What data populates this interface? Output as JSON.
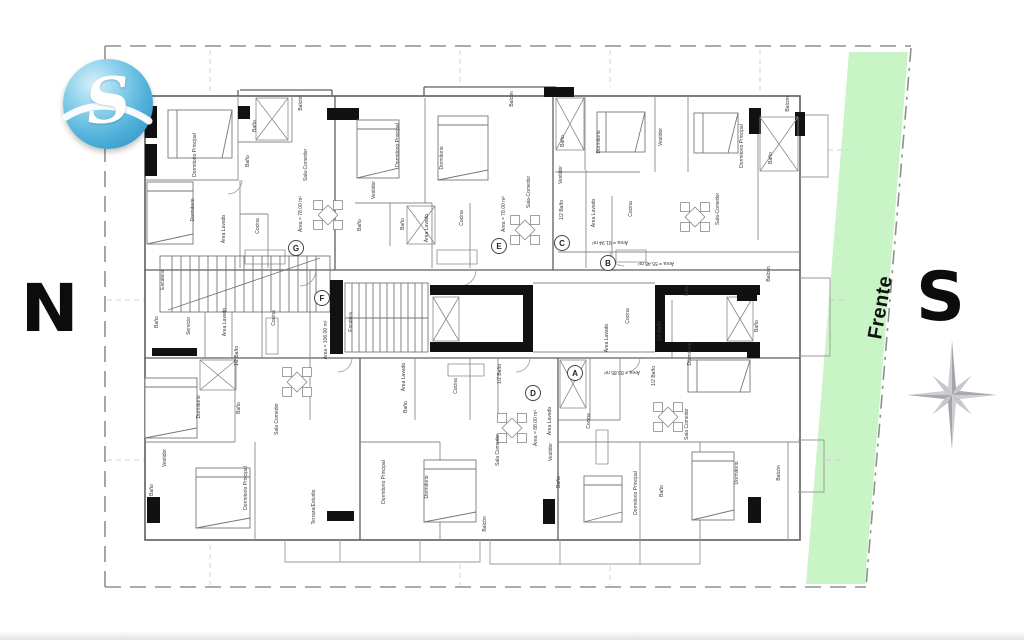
{
  "logo": {
    "letter": "S",
    "color_main": "#4fb0d9",
    "color_light": "#d6f0fa",
    "color_dark": "#2c8cba"
  },
  "compass": {
    "north_label": "N",
    "south_label": "S",
    "star_color": "#b0b0b6"
  },
  "site": {
    "frente_label": "Frente",
    "strip_color": "#c9f4c6",
    "boundary_color": "#8f8f8f"
  },
  "plan": {
    "wall_color": "#666666",
    "label_color": "#3a3a3a",
    "units": [
      {
        "letter": "A",
        "area": "Área = 83.85 m²",
        "cx": 575,
        "cy": 373,
        "ax": 622,
        "ay": 371,
        "ar": 180
      },
      {
        "letter": "B",
        "area": "Área = 55.48 m²",
        "cx": 608,
        "cy": 263,
        "ax": 656,
        "ay": 262,
        "ar": 180
      },
      {
        "letter": "C",
        "area": "Área = 91.94 m²",
        "cx": 562,
        "cy": 243,
        "ax": 610,
        "ay": 241,
        "ar": 180
      },
      {
        "letter": "D",
        "area": "Área = 88.00 m²",
        "cx": 533,
        "cy": 393,
        "ax": 537,
        "ay": 428,
        "ar": -90
      },
      {
        "letter": "E",
        "area": "Área = 78.00 m²",
        "cx": 499,
        "cy": 246,
        "ax": 505,
        "ay": 214,
        "ar": -90
      },
      {
        "letter": "F",
        "area": "Área = 106.00 m²",
        "cx": 322,
        "cy": 298,
        "ax": 327,
        "ay": 340,
        "ar": -90
      },
      {
        "letter": "G",
        "area": "Área = 78.00 m²",
        "cx": 296,
        "cy": 248,
        "ax": 302,
        "ay": 214,
        "ar": -90
      }
    ],
    "rooms": [
      {
        "t": "Balcón",
        "x": 302,
        "y": 103,
        "r": -90
      },
      {
        "t": "Balcón",
        "x": 513,
        "y": 99,
        "r": -90
      },
      {
        "t": "Balcón",
        "x": 789,
        "y": 104,
        "r": -90
      },
      {
        "t": "Dormitorio Principal",
        "x": 196,
        "y": 155,
        "r": -90
      },
      {
        "t": "Dormitorio",
        "x": 194,
        "y": 210,
        "r": -90
      },
      {
        "t": "Baño",
        "x": 256,
        "y": 126,
        "r": -90
      },
      {
        "t": "Baño",
        "x": 249,
        "y": 161,
        "r": -90
      },
      {
        "t": "Área Lavado",
        "x": 225,
        "y": 229,
        "r": -90
      },
      {
        "t": "Cocina",
        "x": 259,
        "y": 226,
        "r": -90
      },
      {
        "t": "Sala-Comedor",
        "x": 307,
        "y": 165,
        "r": -90
      },
      {
        "t": "Dormitorio Principal",
        "x": 399,
        "y": 145,
        "r": -90
      },
      {
        "t": "Dormitorio",
        "x": 443,
        "y": 158,
        "r": -90
      },
      {
        "t": "Vestidor",
        "x": 375,
        "y": 190,
        "r": -90
      },
      {
        "t": "Baño",
        "x": 361,
        "y": 225,
        "r": -90
      },
      {
        "t": "Baño",
        "x": 404,
        "y": 224,
        "r": -90
      },
      {
        "t": "Área Lavado",
        "x": 428,
        "y": 228,
        "r": -90
      },
      {
        "t": "Cocina",
        "x": 463,
        "y": 218,
        "r": -90
      },
      {
        "t": "Sala-Comedor",
        "x": 530,
        "y": 192,
        "r": -90
      },
      {
        "t": "Baño",
        "x": 564,
        "y": 141,
        "r": -90
      },
      {
        "t": "Dormitorio",
        "x": 600,
        "y": 142,
        "r": -90
      },
      {
        "t": "Vestidor",
        "x": 662,
        "y": 137,
        "r": -90
      },
      {
        "t": "Dormitorio Principal",
        "x": 743,
        "y": 146,
        "r": -90
      },
      {
        "t": "Baño",
        "x": 772,
        "y": 158,
        "r": -90
      },
      {
        "t": "Vestidor",
        "x": 562,
        "y": 175,
        "r": -90
      },
      {
        "t": "1/2 Baño",
        "x": 563,
        "y": 210,
        "r": -90
      },
      {
        "t": "Área Lavado",
        "x": 595,
        "y": 213,
        "r": -90
      },
      {
        "t": "Cocina",
        "x": 632,
        "y": 209,
        "r": -90
      },
      {
        "t": "Sala-Comedor",
        "x": 719,
        "y": 209,
        "r": -90
      },
      {
        "t": "Escalera",
        "x": 164,
        "y": 280,
        "r": -90
      },
      {
        "t": "Baño",
        "x": 158,
        "y": 322,
        "r": -90
      },
      {
        "t": "Servicio",
        "x": 190,
        "y": 326,
        "r": -90
      },
      {
        "t": "Área Lavado",
        "x": 226,
        "y": 322,
        "r": -90
      },
      {
        "t": "Cocina",
        "x": 275,
        "y": 318,
        "r": -90
      },
      {
        "t": "1/2 Baño",
        "x": 238,
        "y": 356,
        "r": -90
      },
      {
        "t": "Escalera",
        "x": 352,
        "y": 322,
        "r": -90
      },
      {
        "t": "Cocina",
        "x": 629,
        "y": 316,
        "r": -90
      },
      {
        "t": "Área Lavado",
        "x": 608,
        "y": 338,
        "r": -90
      },
      {
        "t": "1/2 Baño",
        "x": 661,
        "y": 331,
        "r": -90
      },
      {
        "t": "Sala",
        "x": 688,
        "y": 291,
        "r": -90
      },
      {
        "t": "Balcón",
        "x": 770,
        "y": 274,
        "r": -90
      },
      {
        "t": "Baño",
        "x": 758,
        "y": 326,
        "r": -90
      },
      {
        "t": "Dormitorio",
        "x": 691,
        "y": 354,
        "r": -90
      },
      {
        "t": "Dormitorio",
        "x": 200,
        "y": 407,
        "r": -90
      },
      {
        "t": "Baño",
        "x": 240,
        "y": 408,
        "r": -90
      },
      {
        "t": "Vestidor",
        "x": 166,
        "y": 458,
        "r": -90
      },
      {
        "t": "Baño",
        "x": 153,
        "y": 490,
        "r": -90
      },
      {
        "t": "Dormitorio Principal",
        "x": 247,
        "y": 488,
        "r": -90
      },
      {
        "t": "Sala Comedor",
        "x": 278,
        "y": 419,
        "r": -90
      },
      {
        "t": "Terraza/Estudio",
        "x": 315,
        "y": 507,
        "r": -90
      },
      {
        "t": "Área Lavado",
        "x": 405,
        "y": 377,
        "r": -90
      },
      {
        "t": "Cocina",
        "x": 457,
        "y": 386,
        "r": -90
      },
      {
        "t": "Baño",
        "x": 407,
        "y": 407,
        "r": -90
      },
      {
        "t": "1/2 Baño",
        "x": 501,
        "y": 374,
        "r": -90
      },
      {
        "t": "Dormitorio Principal",
        "x": 385,
        "y": 482,
        "r": -90
      },
      {
        "t": "Dormitorio",
        "x": 428,
        "y": 487,
        "r": -90
      },
      {
        "t": "Sala Comedor",
        "x": 499,
        "y": 450,
        "r": -90
      },
      {
        "t": "Balcón",
        "x": 486,
        "y": 524,
        "r": -90
      },
      {
        "t": "Área Lavado",
        "x": 551,
        "y": 421,
        "r": -90
      },
      {
        "t": "Vestidor",
        "x": 552,
        "y": 452,
        "r": -90
      },
      {
        "t": "Baño",
        "x": 560,
        "y": 482,
        "r": -90
      },
      {
        "t": "1/2 Baño",
        "x": 655,
        "y": 376,
        "r": -90
      },
      {
        "t": "Cocina",
        "x": 590,
        "y": 421,
        "r": -90
      },
      {
        "t": "Sala Comedor",
        "x": 688,
        "y": 424,
        "r": -90
      },
      {
        "t": "Dormitorio Principal",
        "x": 637,
        "y": 493,
        "r": -90
      },
      {
        "t": "Baño",
        "x": 663,
        "y": 491,
        "r": -90
      },
      {
        "t": "Dormitorio",
        "x": 738,
        "y": 473,
        "r": -90
      },
      {
        "t": "Balcón",
        "x": 780,
        "y": 473,
        "r": -90
      }
    ],
    "dining": [
      [
        328,
        215
      ],
      [
        525,
        230
      ],
      [
        695,
        217
      ],
      [
        297,
        382
      ],
      [
        512,
        428
      ],
      [
        668,
        417
      ]
    ],
    "beds": [
      [
        168,
        110,
        64,
        48
      ],
      [
        147,
        182,
        46,
        62
      ],
      [
        357,
        120,
        42,
        58
      ],
      [
        438,
        116,
        50,
        64
      ],
      [
        597,
        112,
        48,
        40
      ],
      [
        694,
        113,
        44,
        40
      ],
      [
        688,
        360,
        62,
        32
      ],
      [
        145,
        378,
        52,
        60
      ],
      [
        196,
        468,
        54,
        60
      ],
      [
        424,
        460,
        52,
        62
      ],
      [
        584,
        476,
        38,
        46
      ],
      [
        692,
        452,
        42,
        68
      ]
    ]
  }
}
